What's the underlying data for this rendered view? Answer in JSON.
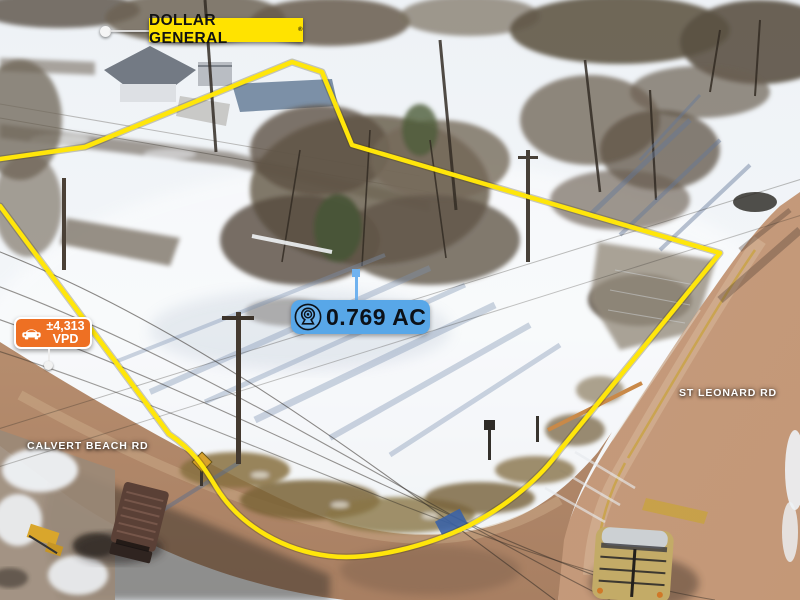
{
  "overlays": {
    "store_label": {
      "text": "DOLLAR GENERAL",
      "registered_mark": "®",
      "bg_color": "#FFE300"
    },
    "acreage_badge": {
      "text": "0.769 AC",
      "icon": "location-pin-icon",
      "bg_color": "#58A7E8"
    },
    "traffic_badge": {
      "count": "±4,313",
      "unit": "VPD",
      "icon": "car-icon",
      "bg_color": "#EE7023"
    },
    "road_labels": [
      {
        "text": "CALVERT BEACH RD"
      },
      {
        "text": "ST LEONARD RD"
      }
    ],
    "boundary_color": "#FFE60A"
  }
}
